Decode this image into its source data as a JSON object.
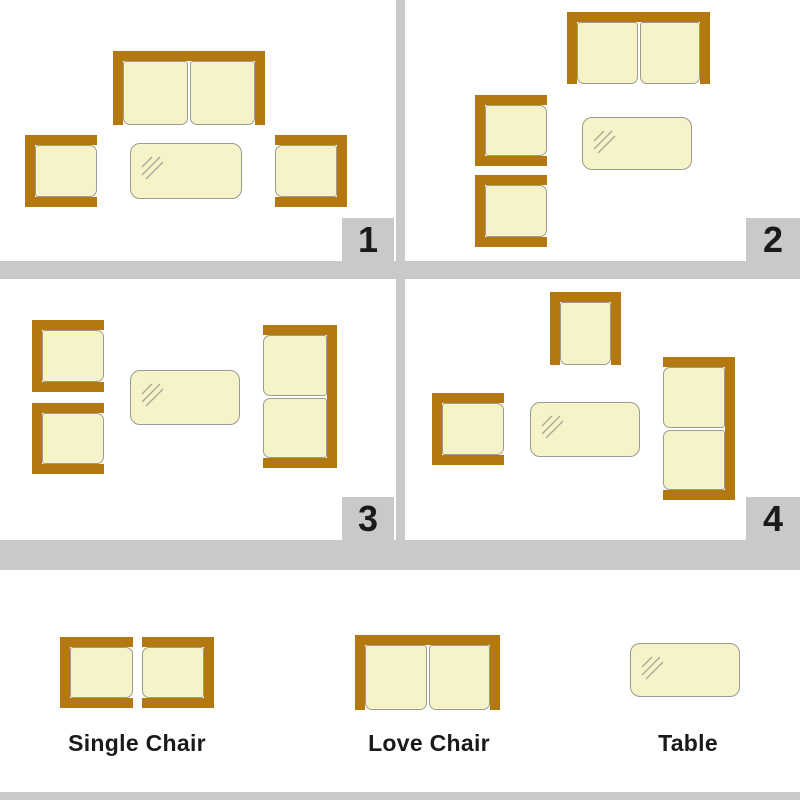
{
  "colors": {
    "wood": "#b3780f",
    "cushion": "#f7f3c8",
    "outline": "#9b9b90",
    "bar_gray": "#c9c9cb",
    "ink": "#1a1a1a",
    "shine": "#a6a69a"
  },
  "panels": [
    {
      "number": "1",
      "items": [
        {
          "type": "love",
          "open": "bottom",
          "x": 113,
          "y": 51,
          "w": 152,
          "h": 74
        },
        {
          "type": "single",
          "open": "right",
          "x": 25,
          "y": 135,
          "w": 72,
          "h": 72
        },
        {
          "type": "single",
          "open": "left",
          "x": 275,
          "y": 135,
          "w": 72,
          "h": 72
        },
        {
          "type": "table",
          "x": 130,
          "y": 143,
          "w": 112,
          "h": 56
        }
      ]
    },
    {
      "number": "2",
      "items": [
        {
          "type": "love",
          "open": "bottom",
          "x": 567,
          "y": 12,
          "w": 143,
          "h": 72
        },
        {
          "type": "single",
          "open": "right",
          "x": 475,
          "y": 95,
          "w": 72,
          "h": 71
        },
        {
          "type": "single",
          "open": "right",
          "x": 475,
          "y": 175,
          "w": 72,
          "h": 72
        },
        {
          "type": "table",
          "x": 582,
          "y": 117,
          "w": 110,
          "h": 53
        }
      ]
    },
    {
      "number": "3",
      "items": [
        {
          "type": "single",
          "open": "right",
          "x": 32,
          "y": 320,
          "w": 72,
          "h": 72
        },
        {
          "type": "single",
          "open": "right",
          "x": 32,
          "y": 403,
          "w": 72,
          "h": 71
        },
        {
          "type": "table",
          "x": 130,
          "y": 370,
          "w": 110,
          "h": 55
        },
        {
          "type": "love",
          "open": "left",
          "x": 263,
          "y": 325,
          "w": 74,
          "h": 143
        }
      ]
    },
    {
      "number": "4",
      "items": [
        {
          "type": "single",
          "open": "bottom",
          "x": 550,
          "y": 292,
          "w": 71,
          "h": 73
        },
        {
          "type": "single",
          "open": "right",
          "x": 432,
          "y": 393,
          "w": 72,
          "h": 72
        },
        {
          "type": "table",
          "x": 530,
          "y": 402,
          "w": 110,
          "h": 55
        },
        {
          "type": "love",
          "open": "left",
          "x": 663,
          "y": 357,
          "w": 72,
          "h": 143
        }
      ]
    }
  ],
  "legend": {
    "items": [
      {
        "label": "Single Chair",
        "items": [
          {
            "type": "single",
            "open": "right",
            "x": 60,
            "y": 637,
            "w": 73,
            "h": 71
          },
          {
            "type": "single",
            "open": "left",
            "x": 142,
            "y": 637,
            "w": 72,
            "h": 71
          }
        ]
      },
      {
        "label": "Love Chair",
        "items": [
          {
            "type": "love",
            "open": "bottom",
            "x": 355,
            "y": 635,
            "w": 145,
            "h": 75
          }
        ]
      },
      {
        "label": "Table",
        "items": [
          {
            "type": "table",
            "x": 630,
            "y": 643,
            "w": 110,
            "h": 54
          }
        ]
      }
    ]
  }
}
